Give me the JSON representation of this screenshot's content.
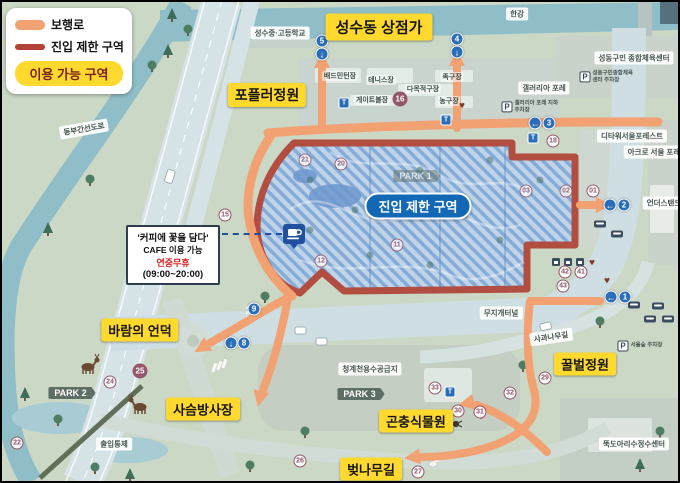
{
  "colors": {
    "yellow": "#FFD92E",
    "orange": "#F2A172",
    "red": "#B04236",
    "pill_blue": "#1268B5",
    "badge_plum": "#94566A",
    "gate_blue": "#2A6DB8"
  },
  "legend": {
    "items": [
      {
        "label": "보행로"
      },
      {
        "label": "진입 제한 구역"
      }
    ],
    "available_area_label": "이용 가능 구역"
  },
  "restricted_zone": {
    "label": "진입 제한 구역"
  },
  "cafe": {
    "title": "'커피에 꽃을 담다'",
    "line2": "CAFE 이용 가능",
    "line3": "연중무휴",
    "line4": "(09:00~20:00)"
  },
  "area_labels": [
    {
      "id": "seongsu-shops",
      "text": "성수동 상점가",
      "x": 379,
      "y": 27,
      "size": 15
    },
    {
      "id": "poplar-garden",
      "text": "포플러정원",
      "x": 267,
      "y": 95,
      "size": 14
    },
    {
      "id": "wind-hill",
      "text": "바람의 언덕",
      "x": 140,
      "y": 330,
      "size": 13
    },
    {
      "id": "deer-field",
      "text": "사슴방사장",
      "x": 203,
      "y": 409,
      "size": 13
    },
    {
      "id": "insect-garden",
      "text": "곤충식물원",
      "x": 416,
      "y": 421,
      "size": 13
    },
    {
      "id": "cherry-road",
      "text": "벚나무길",
      "x": 371,
      "y": 469,
      "size": 13
    },
    {
      "id": "bee-garden",
      "text": "꿀벌정원",
      "x": 585,
      "y": 364,
      "size": 13
    }
  ],
  "map_chips": [
    {
      "t": "한강",
      "x": 517,
      "y": 14
    },
    {
      "t": "성수중·고등학교",
      "x": 280,
      "y": 33
    },
    {
      "t": "성동구민 종합체육센터",
      "x": 634,
      "y": 58
    },
    {
      "t": "갤러리아 포레",
      "x": 544,
      "y": 88
    },
    {
      "t": "디타워서울포레스트",
      "x": 632,
      "y": 136
    },
    {
      "t": "아크로 서울 포레",
      "x": 654,
      "y": 152
    },
    {
      "t": "언더스탠드",
      "x": 664,
      "y": 203
    },
    {
      "t": "무지개터널",
      "x": 501,
      "y": 313
    },
    {
      "t": "사과나무길",
      "x": 551,
      "y": 337,
      "r": -8
    },
    {
      "t": "뚝도아리수정수센터",
      "x": 634,
      "y": 444
    },
    {
      "t": "청계천용수공급지",
      "x": 370,
      "y": 369
    },
    {
      "t": "출입통제",
      "x": 114,
      "y": 444
    },
    {
      "t": "동부간선도로",
      "x": 84,
      "y": 129,
      "r": -10
    }
  ],
  "park_signs": [
    {
      "t": "PARK 2",
      "x": 72,
      "y": 393
    },
    {
      "t": "PARK 3",
      "x": 361,
      "y": 394
    },
    {
      "t": "PARK 1",
      "x": 417,
      "y": 176,
      "faint": true
    }
  ],
  "facilities": [
    {
      "t": "배드민턴장",
      "x": 340,
      "y": 76
    },
    {
      "t": "테니스장",
      "x": 381,
      "y": 80
    },
    {
      "t": "다목적구장",
      "x": 423,
      "y": 89
    },
    {
      "t": "게이트볼장",
      "x": 372,
      "y": 100
    },
    {
      "t": "족구장",
      "x": 452,
      "y": 77
    },
    {
      "t": "농구장",
      "x": 449,
      "y": 101
    }
  ],
  "badges": [
    {
      "n": "15",
      "x": 225,
      "y": 215
    },
    {
      "n": "16",
      "x": 400,
      "y": 99,
      "filled": true
    },
    {
      "n": "18",
      "x": 553,
      "y": 141
    },
    {
      "n": "01",
      "x": 593,
      "y": 191
    },
    {
      "n": "02",
      "x": 566,
      "y": 191,
      "zone": true
    },
    {
      "n": "03",
      "x": 526,
      "y": 191,
      "zone": true
    },
    {
      "n": "21",
      "x": 305,
      "y": 160,
      "zone": true
    },
    {
      "n": "20",
      "x": 341,
      "y": 164,
      "zone": true
    },
    {
      "n": "11",
      "x": 397,
      "y": 245,
      "zone": true
    },
    {
      "n": "12",
      "x": 321,
      "y": 261,
      "zone": true
    },
    {
      "n": "22",
      "x": 17,
      "y": 443
    },
    {
      "n": "24",
      "x": 110,
      "y": 382
    },
    {
      "n": "25",
      "x": 140,
      "y": 371,
      "filled": true
    },
    {
      "n": "26",
      "x": 300,
      "y": 461
    },
    {
      "n": "27",
      "x": 418,
      "y": 472
    },
    {
      "n": "29",
      "x": 545,
      "y": 378
    },
    {
      "n": "30",
      "x": 458,
      "y": 411
    },
    {
      "n": "31",
      "x": 480,
      "y": 412
    },
    {
      "n": "32",
      "x": 510,
      "y": 393
    },
    {
      "n": "33",
      "x": 435,
      "y": 388
    },
    {
      "n": "41",
      "x": 581,
      "y": 272
    },
    {
      "n": "42",
      "x": 565,
      "y": 272
    },
    {
      "n": "43",
      "x": 563,
      "y": 286
    }
  ],
  "gates": [
    {
      "n": "5",
      "x": 322,
      "y": 41,
      "a": "↓",
      "ax": 322,
      "ay": 54
    },
    {
      "n": "4",
      "x": 457,
      "y": 39,
      "a": "↓",
      "ax": 457,
      "ay": 52
    },
    {
      "n": "3",
      "x": 549,
      "y": 123,
      "a": "←",
      "ax": 535,
      "ay": 123
    },
    {
      "n": "2",
      "x": 624,
      "y": 205,
      "a": "←",
      "ax": 610,
      "ay": 205
    },
    {
      "n": "1",
      "x": 625,
      "y": 297,
      "a": "←",
      "ax": 611,
      "ay": 297
    },
    {
      "n": "9",
      "x": 254,
      "y": 309
    },
    {
      "n": "8",
      "x": 244,
      "y": 343,
      "a": "↓",
      "ax": 231,
      "ay": 343
    }
  ],
  "poi": {
    "restroom_glyph": "T",
    "heart_glyph": "♥",
    "parking_glyph": "P",
    "toilets": [
      [
        344,
        103
      ],
      [
        446,
        120
      ],
      [
        533,
        138
      ],
      [
        450,
        392
      ]
    ],
    "hearts": [
      [
        462,
        106
      ],
      [
        592,
        263
      ],
      [
        607,
        281
      ]
    ],
    "buses": [
      [
        600,
        224
      ],
      [
        617,
        234
      ],
      [
        634,
        305
      ],
      [
        658,
        306
      ],
      [
        650,
        319
      ],
      [
        668,
        319
      ]
    ],
    "kiosks": [
      [
        556,
        262
      ],
      [
        568,
        262
      ],
      [
        580,
        262
      ]
    ],
    "parkings": [
      {
        "x": 530,
        "y": 107,
        "label": "갤러리아 포레 지하주차장"
      },
      {
        "x": 608,
        "y": 77,
        "label": "성동구민종합체육센터 주차장"
      },
      {
        "x": 646,
        "y": 346,
        "label": "서울숲 주차장"
      }
    ]
  }
}
